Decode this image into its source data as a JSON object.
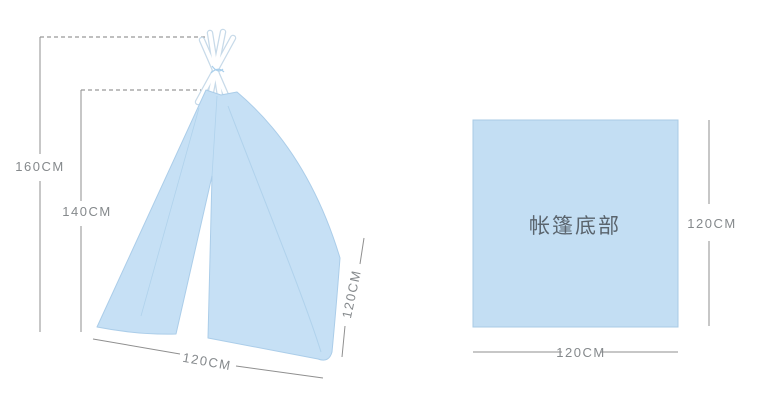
{
  "diagram": {
    "tent": {
      "total_height_label": "160CM",
      "fabric_height_label": "140CM",
      "base_width_label": "120CM",
      "side_depth_label": "120CM"
    },
    "base_panel": {
      "title": "帐篷底部",
      "side_height_label": "120CM",
      "bottom_width_label": "120CM"
    },
    "colors": {
      "fabric_fill": "#c6e0f5",
      "fabric_edge": "#abcde9",
      "pole_edge": "#c7dae9",
      "base_fill": "#c3def3",
      "base_edge": "#a8cbe6",
      "dimension_line": "#8f8f8f",
      "dimension_text": "#85898c",
      "base_title_text": "#5a646d"
    }
  }
}
